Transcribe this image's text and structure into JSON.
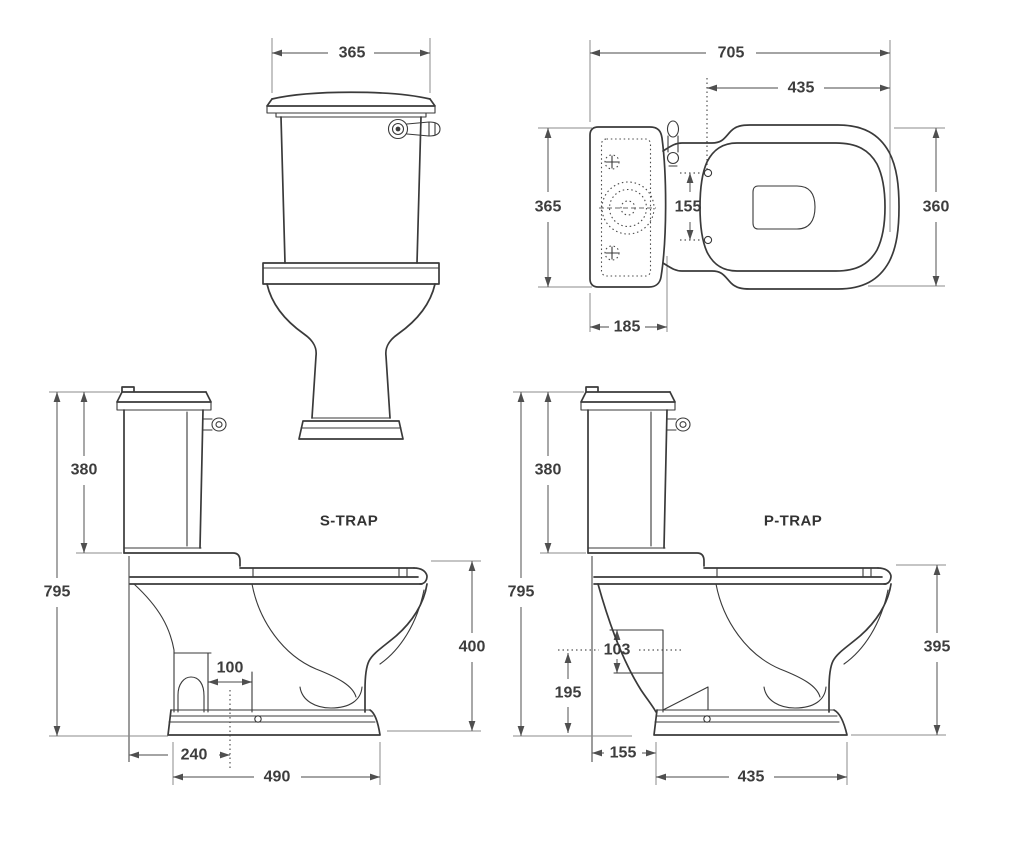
{
  "drawing": {
    "background": "#ffffff",
    "object_line_color": "#3a3a3a",
    "dimension_line_color": "#6d6d6d",
    "text_color": "#3d3d3d",
    "views": {
      "front": {
        "dims": {
          "width": "365"
        }
      },
      "plan": {
        "dims": {
          "overall_length": "705",
          "seat_length": "435",
          "cistern_depth": "365",
          "hinge_centres": "155",
          "cistern_length": "185",
          "bowl_width": "360"
        }
      },
      "s_trap": {
        "label": "S-TRAP",
        "dims": {
          "cistern_height": "380",
          "overall_height": "795",
          "rim_height": "400",
          "trap_width": "100",
          "outlet_setout": "240",
          "base_depth": "490"
        }
      },
      "p_trap": {
        "label": "P-TRAP",
        "dims": {
          "cistern_height": "380",
          "overall_height": "795",
          "outlet_bore": "103",
          "outlet_centre_height": "195",
          "wall_to_base": "155",
          "base_depth": "435",
          "rim_height": "395"
        }
      }
    }
  }
}
